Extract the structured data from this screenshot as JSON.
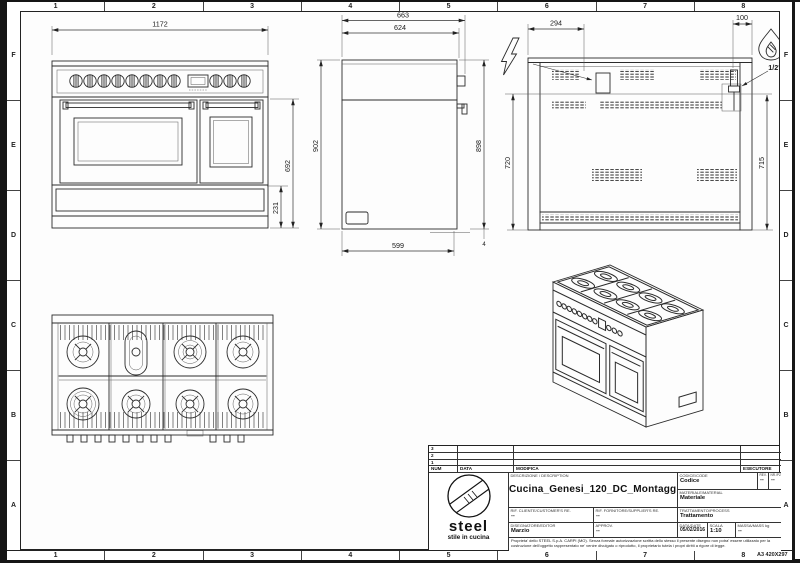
{
  "sheet": {
    "cols": [
      "1",
      "2",
      "3",
      "4",
      "5",
      "6",
      "7",
      "8"
    ],
    "rows": [
      "F",
      "E",
      "D",
      "C",
      "B",
      "A"
    ],
    "format": "A3 420X297"
  },
  "dims": {
    "front_width": "1172",
    "front_body_height": "692",
    "front_plinth": "231",
    "side_depth_total": "663",
    "side_depth_top": "624",
    "side_height_left": "902",
    "side_height_right": "898",
    "side_depth_base": "599",
    "side_foot": "4",
    "back_elec_x": "294",
    "back_gas_x": "100",
    "back_height_left": "720",
    "back_height_right": "715",
    "gas_conn": "1/2\""
  },
  "title_block": {
    "rev_rows": [
      "3",
      "2",
      "1"
    ],
    "headers": {
      "num": "NUM",
      "data": "DATA",
      "modifica": "MODIFICA",
      "esecutore": "ESECUTORE"
    },
    "logo_name": "steel",
    "logo_tagline": "stile in cucina",
    "description_label": "DESCRIZIONE / DESCRIPTION",
    "description": "Cucina_Genesi_120_DC_Montaggio",
    "codice_label": "CODICE/CODE",
    "codice": "Codice",
    "rev_label": "REV.",
    "rev": "--",
    "nrpz_label": "NR./PZ.",
    "nrpz": "--",
    "materiale_label": "MATERIALE/MATERIAL",
    "materiale": "Materiale",
    "rif_cliente_label": "RIF. CLIENTE/CUSTOMER'S RE.",
    "rif_cliente": "--",
    "rif_fornitore_label": "RIF. FORNITORE/SUPPLIER'S RE.",
    "rif_fornitore": "--",
    "trattamento_label": "TRATTAMENTO/PROCESS",
    "trattamento": "Trattamento",
    "disegnatore_label": "DISEGNATORE/EDITOR",
    "disegnatore": "Marzio",
    "approv_label": "APPROV.",
    "approv": "--",
    "data_label": "DATA/DATE",
    "data": "05/02/2016",
    "scala_label": "SCALA",
    "scala": "1:10",
    "massa_label": "MASSA/MASS kg",
    "massa": "--",
    "disclaimer": "Proprieta' dello STEEL S.p.A. CARPI (MO). Senza formale autorizzazione scritta dello stesso il presente disegno non potra' essere utilizzato per la costruzione dell'oggetto rappresentato ne' venire divulgato o riprodotto, il proprietario tutela i propri diritti a rigore di legge."
  }
}
